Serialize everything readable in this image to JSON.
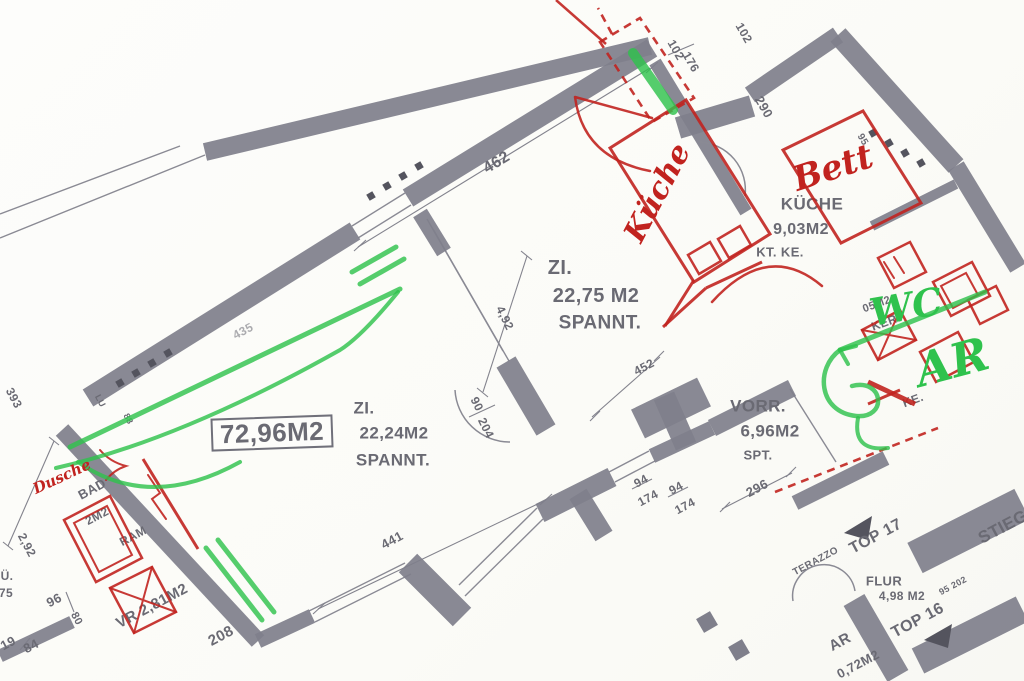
{
  "title": "Scanned apartment floor plan with red and green hand annotations",
  "palette": {
    "wall": "#7f7f8b",
    "wall_dark": "#54545e",
    "thin_line": "#8a8a94",
    "dim_line": "#83838d",
    "print_text": "#6a6a73",
    "annotation_red": "#c1231f",
    "annotation_green": "#2fc24d",
    "paper": "#fbfbf8"
  },
  "rooms_summary": [
    {
      "name": "ZI.",
      "area": "22,75 M2",
      "note": "SPANNT."
    },
    {
      "name": "ZI.",
      "area": "22,24M2",
      "note": "SPANNT."
    },
    {
      "name": "KÜCHE",
      "area": "9,03M2",
      "note": "KT. KE."
    },
    {
      "name": "VORR.",
      "area": "6,96M2",
      "note": "SPT."
    },
    {
      "name": "FLUR",
      "area": "4,98 M2",
      "note": ""
    },
    {
      "name": "BAD",
      "area": "2M2",
      "note": "RAM"
    },
    {
      "name": "VR",
      "area": "2,81M2",
      "note": ""
    },
    {
      "name": "AR",
      "area": "0,72M2",
      "note": ""
    },
    {
      "name": "TOTAL",
      "area": "72,96M2",
      "note": "boxed label"
    }
  ],
  "handwritten_annotations": {
    "red": [
      "Bett",
      "Küche",
      "Dusche"
    ],
    "green": [
      "WC",
      "AR"
    ]
  },
  "labels": [
    {
      "n": "room-zi2-name",
      "t": "ZI.",
      "x": 560,
      "y": 268,
      "r": 0,
      "s": 20,
      "c": "g"
    },
    {
      "n": "room-zi2-area",
      "t": "22,75 M2",
      "x": 596,
      "y": 296,
      "r": 0,
      "s": 20,
      "c": "g"
    },
    {
      "n": "room-zi2-note",
      "t": "SPANNT.",
      "x": 600,
      "y": 323,
      "r": 0,
      "s": 19,
      "c": "g"
    },
    {
      "n": "room-zi1-name",
      "t": "ZI.",
      "x": 364,
      "y": 408,
      "r": 0,
      "s": 17,
      "c": "g"
    },
    {
      "n": "room-zi1-area",
      "t": "22,24M2",
      "x": 394,
      "y": 433,
      "r": 0,
      "s": 17,
      "c": "g"
    },
    {
      "n": "room-zi1-note",
      "t": "SPANNT.",
      "x": 393,
      "y": 460,
      "r": 0,
      "s": 17,
      "c": "g"
    },
    {
      "n": "total-area-label",
      "t": "72,96M2",
      "x": 272,
      "y": 433,
      "r": -2,
      "s": 26,
      "c": "g",
      "box": true
    },
    {
      "n": "room-kueche-name",
      "t": "KÜCHE",
      "x": 812,
      "y": 204,
      "r": 0,
      "s": 17,
      "c": "g"
    },
    {
      "n": "room-kueche-area",
      "t": "9,03M2",
      "x": 801,
      "y": 230,
      "r": 0,
      "s": 16,
      "c": "g"
    },
    {
      "n": "room-kueche-note",
      "t": "KT. KE.",
      "x": 780,
      "y": 252,
      "r": 0,
      "s": 13,
      "c": "g"
    },
    {
      "n": "label-ker",
      "t": "KER.",
      "x": 886,
      "y": 322,
      "r": -20,
      "s": 12,
      "c": "g"
    },
    {
      "n": "label-05m2",
      "t": "05M2",
      "x": 877,
      "y": 305,
      "r": -20,
      "s": 11,
      "c": "g"
    },
    {
      "n": "label-ke",
      "t": "KE.",
      "x": 913,
      "y": 400,
      "r": -20,
      "s": 12,
      "c": "g"
    },
    {
      "n": "room-vorr-name",
      "t": "VORR.",
      "x": 758,
      "y": 406,
      "r": 0,
      "s": 17,
      "c": "g"
    },
    {
      "n": "room-vorr-area",
      "t": "6,96M2",
      "x": 770,
      "y": 431,
      "r": 0,
      "s": 17,
      "c": "g"
    },
    {
      "n": "room-vorr-note",
      "t": "SPT.",
      "x": 758,
      "y": 455,
      "r": 0,
      "s": 13,
      "c": "g"
    },
    {
      "n": "room-flur-name",
      "t": "FLUR",
      "x": 884,
      "y": 581,
      "r": 0,
      "s": 13,
      "c": "g"
    },
    {
      "n": "room-flur-area",
      "t": "4,98 M2",
      "x": 902,
      "y": 596,
      "r": 0,
      "s": 12,
      "c": "g"
    },
    {
      "n": "unit-top17-label",
      "t": "TOP 17",
      "x": 876,
      "y": 537,
      "r": -28,
      "s": 16,
      "c": "g"
    },
    {
      "n": "unit-top16-label",
      "t": "TOP 16",
      "x": 918,
      "y": 621,
      "r": -28,
      "s": 16,
      "c": "g"
    },
    {
      "n": "stairs-label",
      "t": "STIEGE",
      "x": 1008,
      "y": 524,
      "r": -28,
      "s": 17,
      "c": "g"
    },
    {
      "n": "terazzo-label",
      "t": "TERAZZO",
      "x": 816,
      "y": 562,
      "r": -28,
      "s": 10,
      "c": "g"
    },
    {
      "n": "room-ar-name",
      "t": "AR",
      "x": 840,
      "y": 642,
      "r": -28,
      "s": 15,
      "c": "g"
    },
    {
      "n": "room-ar-area",
      "t": "0,72M2",
      "x": 858,
      "y": 664,
      "r": -28,
      "s": 13,
      "c": "g"
    },
    {
      "n": "dim-95-202",
      "t": "95 202",
      "x": 953,
      "y": 586,
      "r": -28,
      "s": 9,
      "c": "g"
    },
    {
      "n": "room-bad-name",
      "t": "BAD",
      "x": 92,
      "y": 489,
      "r": -28,
      "s": 13,
      "c": "g"
    },
    {
      "n": "room-bad-area",
      "t": "2M2",
      "x": 97,
      "y": 516,
      "r": -28,
      "s": 12,
      "c": "g"
    },
    {
      "n": "label-ram",
      "t": "RAM",
      "x": 133,
      "y": 536,
      "r": -28,
      "s": 12,
      "c": "g"
    },
    {
      "n": "room-vr-label",
      "t": "VR 2,81M2",
      "x": 152,
      "y": 606,
      "r": -28,
      "s": 15,
      "c": "g"
    },
    {
      "n": "dim-208",
      "t": "208",
      "x": 221,
      "y": 636,
      "r": -28,
      "s": 15,
      "c": "g"
    },
    {
      "n": "dim-96",
      "t": "96",
      "x": 54,
      "y": 600,
      "r": -28,
      "s": 13,
      "c": "g"
    },
    {
      "n": "dim-80",
      "t": "80",
      "x": 76,
      "y": 619,
      "r": 62,
      "s": 11,
      "c": "g"
    },
    {
      "n": "dim-75",
      "t": "75",
      "x": 6,
      "y": 593,
      "r": 0,
      "s": 12,
      "c": "g"
    },
    {
      "n": "label-ue",
      "t": "Ü.",
      "x": 7,
      "y": 576,
      "r": 0,
      "s": 12,
      "c": "g"
    },
    {
      "n": "dim-19",
      "t": "19",
      "x": 8,
      "y": 643,
      "r": -28,
      "s": 13,
      "c": "g"
    },
    {
      "n": "dim-84",
      "t": "84",
      "x": 31,
      "y": 646,
      "r": -28,
      "s": 13,
      "c": "g"
    },
    {
      "n": "dim-2-92",
      "t": "2,92",
      "x": 27,
      "y": 545,
      "r": 62,
      "s": 12,
      "c": "g"
    },
    {
      "n": "dim-393",
      "t": "393",
      "x": 14,
      "y": 398,
      "r": 62,
      "s": 12,
      "c": "g"
    },
    {
      "n": "label-lu",
      "t": "LU",
      "x": 100,
      "y": 401,
      "r": 62,
      "s": 9,
      "c": "g"
    },
    {
      "n": "dim-88",
      "t": "88",
      "x": 128,
      "y": 419,
      "r": 62,
      "s": 9,
      "c": "g"
    },
    {
      "n": "dim-435",
      "t": "435",
      "x": 243,
      "y": 331,
      "r": -28,
      "s": 12,
      "c": "g",
      "o": 0.55
    },
    {
      "n": "dim-462",
      "t": "462",
      "x": 497,
      "y": 163,
      "r": -31,
      "s": 16,
      "c": "g"
    },
    {
      "n": "dim-4-92",
      "t": "4,92",
      "x": 505,
      "y": 318,
      "r": 64,
      "s": 12,
      "c": "g"
    },
    {
      "n": "dim-441",
      "t": "441",
      "x": 392,
      "y": 540,
      "r": -28,
      "s": 13,
      "c": "g"
    },
    {
      "n": "dim-452",
      "t": "452",
      "x": 644,
      "y": 367,
      "r": -28,
      "s": 12,
      "c": "g"
    },
    {
      "n": "dim-296",
      "t": "296",
      "x": 757,
      "y": 488,
      "r": -28,
      "s": 13,
      "c": "g"
    },
    {
      "n": "dim-94-a",
      "t": "94",
      "x": 641,
      "y": 481,
      "r": -28,
      "s": 12,
      "c": "g"
    },
    {
      "n": "dim-174-a",
      "t": "174",
      "x": 648,
      "y": 498,
      "r": -28,
      "s": 12,
      "c": "g"
    },
    {
      "n": "dim-94-b",
      "t": "94",
      "x": 676,
      "y": 488,
      "r": -28,
      "s": 12,
      "c": "g"
    },
    {
      "n": "dim-174-b",
      "t": "174",
      "x": 685,
      "y": 506,
      "r": -28,
      "s": 12,
      "c": "g"
    },
    {
      "n": "dim-90",
      "t": "90",
      "x": 477,
      "y": 404,
      "r": 64,
      "s": 12,
      "c": "g"
    },
    {
      "n": "dim-204",
      "t": "204",
      "x": 486,
      "y": 428,
      "r": 64,
      "s": 12,
      "c": "g"
    },
    {
      "n": "dim-102-a",
      "t": "102",
      "x": 676,
      "y": 50,
      "r": 60,
      "s": 12,
      "c": "g"
    },
    {
      "n": "dim-176",
      "t": "176",
      "x": 691,
      "y": 62,
      "r": 60,
      "s": 12,
      "c": "g"
    },
    {
      "n": "dim-102-b",
      "t": "102",
      "x": 744,
      "y": 33,
      "r": 60,
      "s": 12,
      "c": "g"
    },
    {
      "n": "dim-290",
      "t": "290",
      "x": 764,
      "y": 107,
      "r": 60,
      "s": 13,
      "c": "g"
    },
    {
      "n": "dim-95",
      "t": "95",
      "x": 862,
      "y": 140,
      "r": 60,
      "s": 10,
      "c": "g"
    }
  ],
  "hand_labels": [
    {
      "n": "hand-bett-annotation",
      "t": "Bett",
      "x": 833,
      "y": 168,
      "r": -18,
      "s": 34,
      "c": "red"
    },
    {
      "n": "hand-kueche-annotation",
      "t": "Küche",
      "x": 658,
      "y": 193,
      "r": -62,
      "s": 30,
      "c": "red"
    },
    {
      "n": "hand-dusche-annotation",
      "t": "Dusche",
      "x": 62,
      "y": 477,
      "r": -25,
      "s": 15,
      "c": "red"
    },
    {
      "n": "hand-wc-annotation",
      "t": "WC",
      "x": 906,
      "y": 307,
      "r": -10,
      "s": 38,
      "c": "green"
    },
    {
      "n": "hand-ar-annotation",
      "t": "AR",
      "x": 952,
      "y": 362,
      "r": -15,
      "s": 46,
      "c": "green"
    }
  ],
  "drawing": {
    "walls": [
      [
        88,
        398,
        355,
        231,
        20
      ],
      [
        408,
        198,
        652,
        48,
        20
      ],
      [
        205,
        152,
        650,
        46,
        18
      ],
      [
        62,
        430,
        258,
        641,
        17
      ],
      [
        258,
        641,
        312,
        616,
        15
      ],
      [
        408,
        563,
        462,
        617,
        26
      ],
      [
        540,
        513,
        612,
        477,
        20
      ],
      [
        578,
        494,
        604,
        536,
        20
      ],
      [
        652,
        456,
        712,
        428,
        15
      ],
      [
        712,
        428,
        792,
        388,
        18
      ],
      [
        678,
        128,
        752,
        106,
        22
      ],
      [
        750,
        95,
        838,
        35,
        18
      ],
      [
        838,
        35,
        956,
        166,
        20
      ],
      [
        956,
        166,
        1018,
        268,
        18
      ],
      [
        872,
        226,
        956,
        184,
        10
      ],
      [
        655,
        62,
        746,
        212,
        13
      ],
      [
        420,
        213,
        444,
        252,
        16
      ],
      [
        506,
        362,
        546,
        430,
        22
      ],
      [
        638,
        424,
        704,
        392,
        32
      ],
      [
        664,
        396,
        686,
        446,
        22
      ],
      [
        795,
        503,
        886,
        458,
        15
      ],
      [
        915,
        558,
        1022,
        504,
        34
      ],
      [
        854,
        600,
        898,
        676,
        24
      ],
      [
        918,
        661,
        1022,
        609,
        28
      ],
      [
        0,
        656,
        72,
        622,
        13
      ]
    ],
    "thin": [
      [
        352,
        226,
        405,
        193
      ],
      [
        358,
        238,
        411,
        205
      ],
      [
        309,
        611,
        405,
        563
      ],
      [
        315,
        622,
        411,
        574
      ],
      [
        459,
        585,
        537,
        508
      ],
      [
        465,
        596,
        543,
        519
      ],
      [
        609,
        472,
        649,
        451
      ],
      [
        615,
        482,
        655,
        461
      ],
      [
        427,
        219,
        503,
        351
      ],
      [
        433,
        229,
        509,
        361
      ],
      [
        0,
        238,
        205,
        155
      ],
      [
        0,
        214,
        180,
        146
      ],
      [
        790,
        389,
        836,
        462
      ]
    ],
    "dims": [
      [
        358,
        247,
        650,
        68
      ],
      [
        318,
        609,
        546,
        500
      ],
      [
        592,
        417,
        660,
        357
      ],
      [
        722,
        509,
        792,
        473
      ],
      [
        527,
        256,
        483,
        392
      ],
      [
        54,
        441,
        8,
        546
      ],
      [
        632,
        489,
        652,
        479
      ],
      [
        668,
        497,
        688,
        487
      ],
      [
        469,
        417,
        495,
        405
      ],
      [
        668,
        55,
        694,
        44
      ],
      [
        354,
        251,
        366,
        240
      ],
      [
        646,
        73,
        658,
        62
      ],
      [
        313,
        614,
        325,
        603
      ],
      [
        540,
        505,
        552,
        494
      ],
      [
        590,
        421,
        600,
        411
      ],
      [
        654,
        361,
        664,
        351
      ],
      [
        720,
        512,
        730,
        502
      ],
      [
        786,
        477,
        796,
        467
      ],
      [
        521,
        251,
        532,
        260
      ],
      [
        477,
        388,
        488,
        397
      ],
      [
        49,
        437,
        59,
        445
      ],
      [
        3,
        542,
        13,
        550
      ],
      [
        20,
        650,
        30,
        638
      ],
      [
        66,
        592,
        74,
        612
      ]
    ],
    "gray_paths": [
      "M 455,390 A 55 55 0 0 0 510,442",
      "M 700,142 A 48 48 0 0 1 745,196",
      "M 793,601 A 31 31 0 0 1 855,591"
    ],
    "squares": [
      [
        120,
        383
      ],
      [
        136,
        373
      ],
      [
        152,
        363
      ],
      [
        168,
        353
      ],
      [
        371,
        196
      ],
      [
        387,
        186
      ],
      [
        403,
        176
      ],
      [
        419,
        166
      ],
      [
        873,
        133
      ],
      [
        889,
        143
      ],
      [
        905,
        153
      ],
      [
        921,
        163
      ]
    ],
    "big_squares": [
      [
        707,
        622,
        16
      ],
      [
        739,
        650,
        16
      ]
    ],
    "triangles": [
      [
        [
          844,
          533
        ],
        [
          872,
          516
        ],
        [
          868,
          540
        ]
      ],
      [
        [
          924,
          640
        ],
        [
          952,
          624
        ],
        [
          948,
          648
        ]
      ]
    ],
    "red": {
      "lines": [
        [
          556,
          0,
          606,
          44,
          2.5
        ],
        [
          663,
          327,
          706,
          288,
          3
        ],
        [
          706,
          288,
          762,
          262,
          3
        ],
        [
          694,
          280,
          665,
          326,
          3
        ],
        [
          143,
          459,
          198,
          549,
          3
        ],
        [
          868,
          382,
          915,
          404,
          5
        ],
        [
          868,
          404,
          900,
          390,
          3
        ]
      ],
      "dashed": [
        "M 600,42 L 640,18 L 694,98 L 652,122 Z",
        "M 612,34 L 598,8",
        "M 775,492 L 938,428"
      ],
      "polys": [
        {
          "p": "610,148 686,100 770,234 694,282",
          "w": 3
        },
        {
          "p": "783,150 863,111 921,203 841,243",
          "w": 3
        },
        {
          "p": "688,255 710,242 721,261 699,274",
          "w": 2.5
        },
        {
          "p": "718,239 740,226 751,245 729,258",
          "w": 2.5
        },
        {
          "p": "878,258 910,242 926,272 894,288",
          "w": 2.5
        },
        {
          "p": "933,282 972,262 990,296 951,316",
          "w": 2.5
        },
        {
          "p": "941,286 966,273 978,295 953,308",
          "w": 2
        },
        {
          "p": "862,330 900,310 916,340 878,360",
          "w": 2.5
        },
        {
          "p": "920,352 958,332 974,362 936,382",
          "w": 2.5
        },
        {
          "p": "968,300 996,286 1008,310 980,324",
          "w": 2.5
        },
        {
          "p": "64,520 110,496 142,558 96,582",
          "w": 2.5
        },
        {
          "p": "74,523 107,506 132,555 99,572",
          "w": 2
        },
        {
          "p": "110,588 152,567 176,612 134,633",
          "w": 2.5
        }
      ],
      "paths": [
        {
          "d": "M 652,118 L 575,97 M 575,97 Q 583,158 650,171",
          "w": 2.5
        },
        {
          "d": "M 712,302 Q 768,240 822,286",
          "w": 2.5
        },
        {
          "d": "M 110,588 L 176,612 M 152,567 L 134,633",
          "w": 2
        },
        {
          "d": "M 862,330 L 916,340 M 900,310 L 878,360",
          "w": 2
        },
        {
          "d": "M 148,475 l 12,18 l -8,6 l 14,20",
          "w": 2
        },
        {
          "d": "M 100,450 q 10,12 26,16 q -12,4 -20,14",
          "w": 2
        },
        {
          "d": "M 884,262 l 10,16 M 894,257 l 10,16",
          "w": 2
        }
      ]
    },
    "green": {
      "paths": [
        {
          "d": "M 70,447 L 400,289",
          "w": 5
        },
        {
          "d": "M 56,468 Q 180,440 340,350 Q 362,336 398,292",
          "w": 4
        },
        {
          "d": "M 78,462 Q 150,512 240,462",
          "w": 4
        },
        {
          "d": "M 352,272 L 396,247",
          "w": 5
        },
        {
          "d": "M 360,284 L 404,259",
          "w": 5
        },
        {
          "d": "M 206,548 L 262,620",
          "w": 5
        },
        {
          "d": "M 218,540 L 274,612",
          "w": 5
        },
        {
          "d": "M 633,53 L 673,110",
          "w": 10
        },
        {
          "d": "M 985,292 L 840,350",
          "w": 5
        },
        {
          "d": "M 840,350 C 815,368 818,412 856,416 C 888,419 884,378 852,386",
          "w": 4.5
        },
        {
          "d": "M 858,418 q -6,34 30,30",
          "w": 4
        },
        {
          "d": "M 840,350 l 16,-4",
          "w": 4
        },
        {
          "d": "M 840,350 l 8,14",
          "w": 4
        }
      ]
    }
  }
}
